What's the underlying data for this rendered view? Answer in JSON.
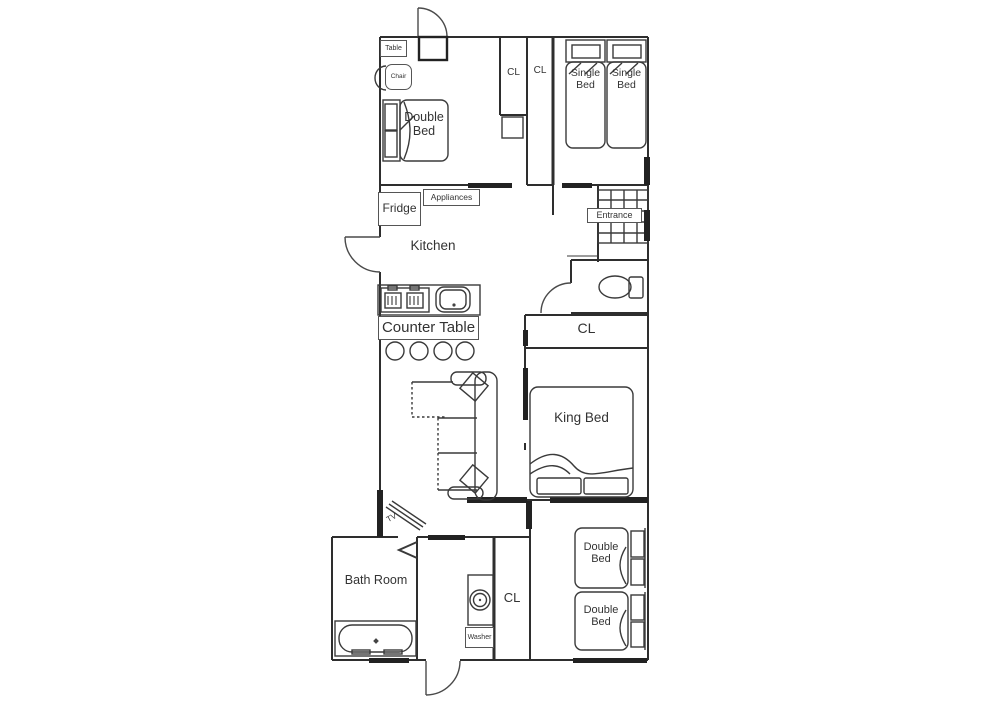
{
  "floorplan": {
    "background": "#ffffff",
    "line_color": "#333333",
    "rooms": {
      "kitchen": "Kitchen",
      "entrance": "Entrance",
      "bath_room": "Bath Room",
      "cl_top_left": "CL",
      "cl_top_right": "CL",
      "cl_hall": "CL",
      "cl_laundry": "CL"
    },
    "furniture": {
      "table": "Table",
      "chair": "Chair",
      "double_bed_top": "Double Bed",
      "single_bed_left": "Single Bed",
      "single_bed_right": "Single Bed",
      "fridge": "Fridge",
      "appliances": "Appliances",
      "counter_table": "Counter Table",
      "king_bed": "King Bed",
      "tv": "TV",
      "washer": "Washer",
      "double_bed_bottom_upper": "Double Bed",
      "double_bed_bottom_lower": "Double Bed"
    }
  }
}
